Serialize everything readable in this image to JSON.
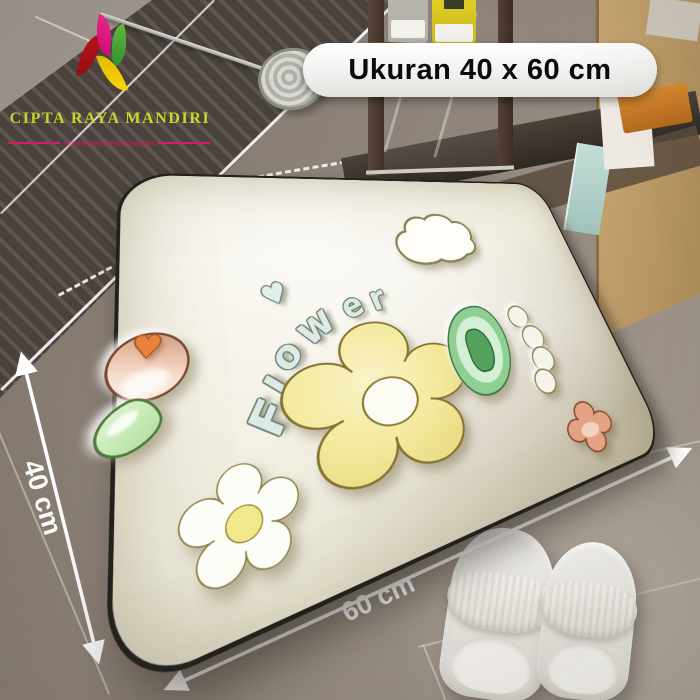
{
  "brand": {
    "name": "CIPTA RAYA MANDIRI",
    "name_color": "#c9d630",
    "petal_colors": {
      "magenta": "#e5087e",
      "red": "#b31217",
      "green": "#4cb33b",
      "yellow": "#ffd400"
    },
    "divider_color": "#d81b6d"
  },
  "size_badge": {
    "label": "Ukuran 40 x 60 cm",
    "text_color": "#0b0b0b",
    "bg_color": "#f6f6f4"
  },
  "dimension_arrows": {
    "left_label": "40 cm",
    "bottom_label": "60 cm",
    "color": "#ffffff"
  },
  "mat": {
    "design_word": "Flower",
    "letters": [
      "F",
      "l",
      "o",
      "w",
      "e",
      "r"
    ],
    "heart_glyph": "♥",
    "base_color": "#f1eee0",
    "flower_color": "#f2e79f",
    "letter_color": "#dcebe7"
  },
  "scene": {
    "floor_color": "#8d8278",
    "props": [
      "shower-drain-brush",
      "shampoo-bottles",
      "glass-shelf",
      "wood-cabinet",
      "white-slippers"
    ]
  }
}
